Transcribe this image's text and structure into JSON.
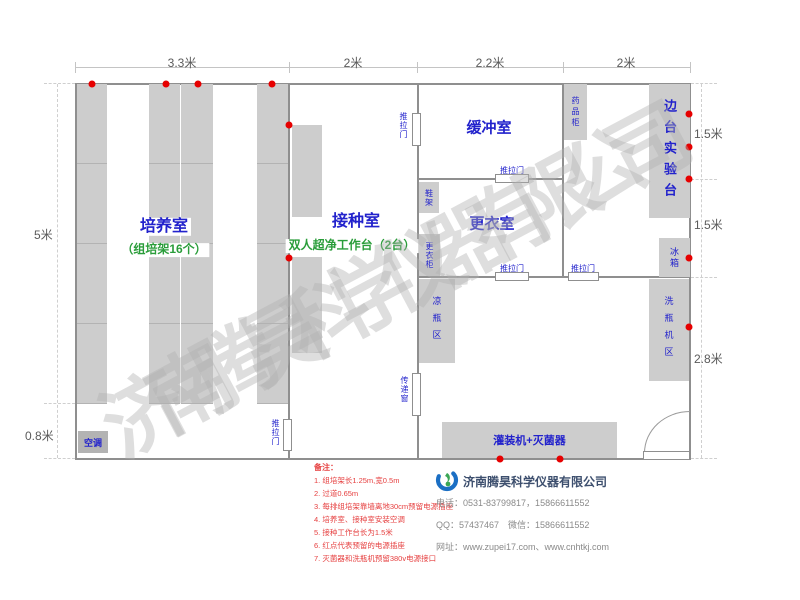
{
  "watermark": "济南腾昊科学仪器有限公司",
  "dims": {
    "top": [
      "3.3米",
      "2米",
      "2.2米",
      "2米"
    ],
    "left": [
      "5米",
      "0.8米"
    ],
    "right": [
      "1.5米",
      "1.5米",
      "2.8米"
    ]
  },
  "rooms": {
    "cultivation": {
      "name": "培养室",
      "sub": "（组培架16个）"
    },
    "inoculation": {
      "name": "接种室",
      "sub": "双人超净工作台（2台）"
    },
    "buffer": {
      "name": "缓冲室"
    },
    "changing": {
      "name": "更衣室"
    },
    "side_bench": {
      "name": "边台实验台"
    }
  },
  "fixtures": {
    "sliding_door": "推拉门",
    "transfer_window": "传递窗",
    "medicine_cabinet": "药品柜",
    "shoe_rack": "鞋架",
    "wardrobe": "更衣柜",
    "fridge": "冰箱",
    "bottle_washer_area": "洗瓶机区",
    "cooling_bottle_area": "凉瓶区",
    "filling_machine": "灌装机+灭菌器",
    "air_conditioner": "空调"
  },
  "notes": {
    "title": "备注：",
    "items": [
      "1. 组培架长1.25m,宽0.5m",
      "2. 过道0.65m",
      "3. 每排组培架靠墙离地30cm预留电源插座",
      "4. 培养室、接种室安装空调",
      "5. 接种工作台长为1.5米",
      "6. 红点代表预留的电源插座",
      "7. 灭菌器和洗瓶机预留380v电源接口"
    ]
  },
  "company": {
    "name": "济南腾昊科学仪器有限公司",
    "phone": "电话：0531-83799817，15866611552",
    "qq_wechat": "QQ：57437467　微信：15866611552",
    "website": "网址：www.zupei17.com、www.cnhtkj.com"
  },
  "colors": {
    "accent_blue": "#2222cc",
    "accent_green": "#2a9d3a",
    "socket_red": "#e60000",
    "note_red": "#e64040",
    "wall_gray": "#8f8f8f",
    "fixture_gray": "#cdcdcd"
  }
}
